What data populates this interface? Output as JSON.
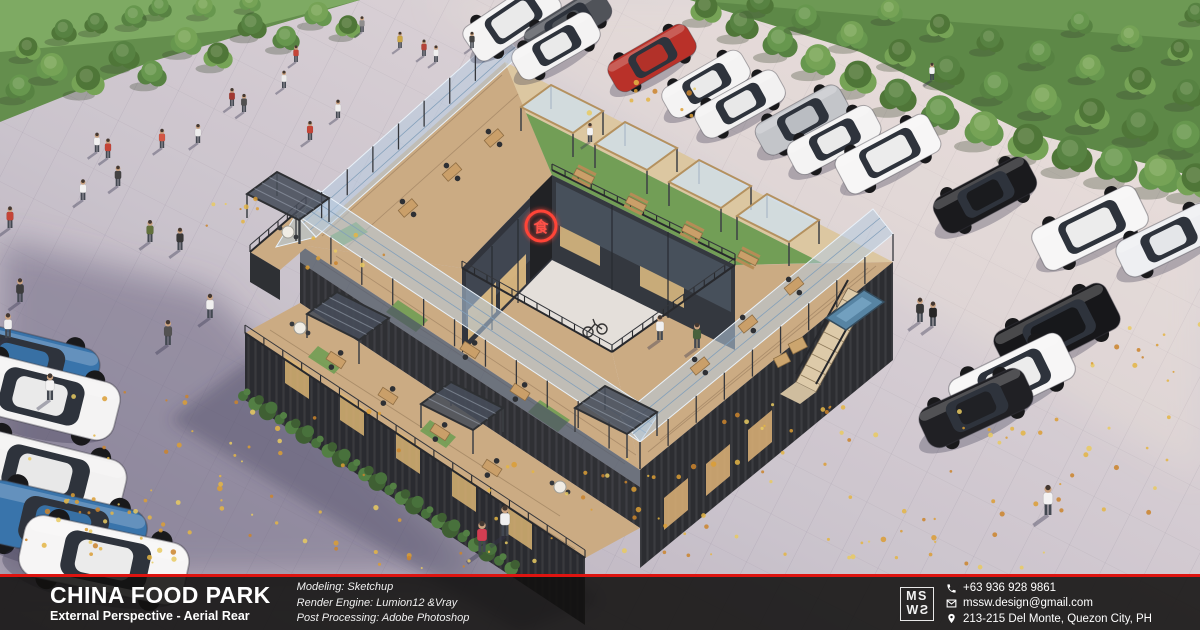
{
  "footer": {
    "project_title": "CHINA FOOD PARK",
    "subtitle": "External Perspective - Aerial Rear",
    "credits": [
      "Modeling: Sketchup",
      "Render Engine: Lumion12 &Vray",
      "Post Processing: Adobe Photoshop"
    ],
    "logo": {
      "top": "MS",
      "bottom": "SW"
    },
    "contacts": [
      {
        "icon": "phone-icon",
        "text": "+63 936 928 9861"
      },
      {
        "icon": "mail-icon",
        "text": "mssw.design@gmail.com"
      },
      {
        "icon": "pin-icon",
        "text": "213-215 Del Monte, Quezon City, PH"
      }
    ],
    "accent_color": "#de1410"
  },
  "sign": {
    "glyph": "食",
    "color": "#ff3b2f"
  },
  "scene": {
    "palette": {
      "tree_greens": [
        "#4e7d39",
        "#5f9346",
        "#6fa04e",
        "#46702f"
      ],
      "leaf_colors": [
        "#e3b33c",
        "#d99a2b",
        "#c97f22",
        "#e8c95a"
      ],
      "hedge_greens": [
        "#3f6b33",
        "#4a7a3b",
        "#35582a"
      ]
    },
    "trees": [
      [
        20,
        96,
        15
      ],
      [
        52,
        76,
        16
      ],
      [
        88,
        90,
        17
      ],
      [
        124,
        64,
        16
      ],
      [
        152,
        82,
        15
      ],
      [
        186,
        50,
        16
      ],
      [
        218,
        64,
        15
      ],
      [
        252,
        34,
        15
      ],
      [
        286,
        46,
        14
      ],
      [
        318,
        22,
        14
      ],
      [
        348,
        34,
        13
      ],
      [
        64,
        38,
        13
      ],
      [
        134,
        24,
        13
      ],
      [
        204,
        14,
        12
      ],
      [
        28,
        56,
        13
      ],
      [
        96,
        30,
        12
      ],
      [
        160,
        14,
        12
      ],
      [
        250,
        8,
        11
      ],
      [
        706,
        18,
        16
      ],
      [
        742,
        34,
        17
      ],
      [
        780,
        52,
        18
      ],
      [
        818,
        70,
        18
      ],
      [
        858,
        88,
        19
      ],
      [
        898,
        106,
        19
      ],
      [
        940,
        124,
        20
      ],
      [
        984,
        140,
        20
      ],
      [
        1028,
        154,
        21
      ],
      [
        1072,
        166,
        21
      ],
      [
        1116,
        176,
        22
      ],
      [
        1160,
        186,
        22
      ],
      [
        1196,
        192,
        20
      ],
      [
        760,
        10,
        14
      ],
      [
        806,
        26,
        15
      ],
      [
        852,
        44,
        16
      ],
      [
        900,
        62,
        16
      ],
      [
        948,
        80,
        17
      ],
      [
        996,
        96,
        17
      ],
      [
        1044,
        110,
        18
      ],
      [
        1092,
        124,
        18
      ],
      [
        1140,
        136,
        19
      ],
      [
        1186,
        148,
        19
      ],
      [
        890,
        18,
        13
      ],
      [
        940,
        34,
        14
      ],
      [
        990,
        48,
        14
      ],
      [
        1040,
        62,
        15
      ],
      [
        1090,
        76,
        15
      ],
      [
        1140,
        90,
        16
      ],
      [
        1188,
        102,
        16
      ],
      [
        1080,
        30,
        13
      ],
      [
        1130,
        44,
        13
      ],
      [
        1180,
        58,
        13
      ],
      [
        1196,
        20,
        12
      ]
    ],
    "cars": [
      [
        512,
        20,
        -34,
        1.0,
        "#f4f4f4",
        "suv"
      ],
      [
        568,
        24,
        -32,
        0.95,
        "#474b52",
        "coupe"
      ],
      [
        556,
        46,
        -30,
        0.95,
        "#f4f4f4",
        "coupe"
      ],
      [
        652,
        58,
        -30,
        0.95,
        "#b6281f",
        "coupe"
      ],
      [
        706,
        84,
        -30,
        0.95,
        "#f4f4f4",
        "coupe"
      ],
      [
        740,
        104,
        -29,
        0.97,
        "#f2f2f2",
        "coupe"
      ],
      [
        802,
        120,
        -29,
        1.0,
        "#c0c3c8",
        "coupe"
      ],
      [
        834,
        140,
        -28,
        1.0,
        "#f4f4f4",
        "coupe"
      ],
      [
        888,
        154,
        -28,
        1.05,
        "#f7f7f7",
        "suv"
      ],
      [
        985,
        195,
        -28,
        1.1,
        "#0e0f12",
        "coupe"
      ],
      [
        1090,
        228,
        -26,
        1.15,
        "#f7f7f7",
        "suv"
      ],
      [
        1168,
        240,
        -26,
        1.1,
        "#eef0f3",
        "coupe"
      ],
      [
        1057,
        330,
        -27,
        1.25,
        "#0b0c0f",
        "suv"
      ],
      [
        1012,
        379,
        -26,
        1.25,
        "#f7f7f7",
        "suv"
      ],
      [
        976,
        408,
        -25,
        1.2,
        "#15161a",
        "coupe"
      ],
      [
        22,
        362,
        14,
        1.6,
        "#2f6ea8",
        "coupe"
      ],
      [
        40,
        396,
        14,
        1.65,
        "#f4f4f4",
        "coupe"
      ],
      [
        44,
        474,
        14,
        1.7,
        "#f2f2f2",
        "coupe"
      ],
      [
        62,
        526,
        13,
        1.75,
        "#2f6ea8",
        "coupe"
      ],
      [
        104,
        560,
        12,
        1.75,
        "#f6f6f6",
        "coupe"
      ]
    ],
    "people": [
      [
        97,
        152,
        "#f2f2f2"
      ],
      [
        108,
        158,
        "#c23b2e"
      ],
      [
        83,
        200,
        "#f2f2f2"
      ],
      [
        118,
        186,
        "#3a3a3a"
      ],
      [
        162,
        148,
        "#d14f3c"
      ],
      [
        198,
        143,
        "#ececec"
      ],
      [
        232,
        106,
        "#9c2f26"
      ],
      [
        244,
        112,
        "#474747"
      ],
      [
        284,
        88,
        "#ececec"
      ],
      [
        296,
        62,
        "#c23b2e"
      ],
      [
        362,
        32,
        "#8a8a8a"
      ],
      [
        400,
        48,
        "#caa43c"
      ],
      [
        424,
        56,
        "#b03a30"
      ],
      [
        436,
        62,
        "#f0f0f0"
      ],
      [
        472,
        48,
        "#3b3b3b"
      ],
      [
        590,
        142,
        "#f4f4f4"
      ],
      [
        310,
        140,
        "#c23b2e"
      ],
      [
        338,
        118,
        "#f0f0f0"
      ],
      [
        10,
        228,
        "#c23b2e"
      ],
      [
        20,
        302,
        "#333333"
      ],
      [
        8,
        338,
        "#f0f0f0"
      ],
      [
        50,
        400,
        "#f4f4f4"
      ],
      [
        150,
        242,
        "#5a6b33"
      ],
      [
        180,
        250,
        "#2e2e2e"
      ],
      [
        210,
        318,
        "#f0f0f0"
      ],
      [
        168,
        345,
        "#4a4a4a"
      ],
      [
        482,
        552,
        "#d0354a"
      ],
      [
        505,
        536,
        "#f0f0f0"
      ],
      [
        920,
        322,
        "#2e2e2e"
      ],
      [
        933,
        326,
        "#1b1b1b"
      ],
      [
        1048,
        515,
        "#f4f4f4"
      ],
      [
        932,
        80,
        "#f4f4f4"
      ],
      [
        660,
        340,
        "#f0f0f0"
      ],
      [
        697,
        348,
        "#3f5a33"
      ]
    ],
    "pergolas": [
      [
        562,
        131,
        "glass"
      ],
      [
        636,
        168,
        "glass"
      ],
      [
        710,
        206,
        "glass"
      ],
      [
        778,
        240,
        "glass"
      ],
      [
        348,
        338,
        "dark"
      ],
      [
        462,
        428,
        "dark"
      ],
      [
        288,
        218,
        "dark"
      ],
      [
        616,
        432,
        "dark"
      ]
    ],
    "tables": [
      [
        408,
        208,
        -41,
        "wood"
      ],
      [
        452,
        172,
        -41,
        "wood"
      ],
      [
        494,
        138,
        -41,
        "wood"
      ],
      [
        584,
        176,
        27,
        "picnic"
      ],
      [
        636,
        204,
        27,
        "picnic"
      ],
      [
        692,
        232,
        27,
        "picnic"
      ],
      [
        748,
        258,
        27,
        "picnic"
      ],
      [
        700,
        366,
        -39,
        "wood"
      ],
      [
        748,
        324,
        -39,
        "wood"
      ],
      [
        794,
        286,
        -39,
        "wood"
      ],
      [
        470,
        350,
        33,
        "wood"
      ],
      [
        520,
        392,
        33,
        "wood"
      ],
      [
        336,
        360,
        33,
        "wood"
      ],
      [
        388,
        396,
        33,
        "wood"
      ],
      [
        440,
        432,
        33,
        "wood"
      ],
      [
        492,
        468,
        33,
        "wood"
      ],
      [
        300,
        328,
        0,
        "round"
      ],
      [
        560,
        487,
        0,
        "round"
      ],
      [
        288,
        232,
        0,
        "round"
      ]
    ],
    "railings": [
      [
        245,
        333,
        585,
        558,
        18,
        8
      ],
      [
        462,
        268,
        612,
        352,
        12,
        7
      ],
      [
        612,
        352,
        735,
        265,
        12,
        7
      ],
      [
        552,
        170,
        735,
        260,
        14,
        6
      ],
      [
        250,
        252,
        306,
        204,
        6,
        7
      ]
    ],
    "canopy_posts": [
      [
        296,
        215,
        501,
        32,
        8,
        26
      ],
      [
        300,
        217,
        640,
        442,
        11,
        27
      ],
      [
        640,
        442,
        893,
        234,
        9,
        27
      ]
    ],
    "hedges": [
      [
        243,
        396,
        560,
        600,
        26
      ]
    ],
    "leaf_clusters": [
      [
        215,
        470,
        190,
        85,
        55
      ],
      [
        100,
        535,
        90,
        38,
        25
      ],
      [
        625,
        512,
        150,
        55,
        35
      ],
      [
        772,
        432,
        70,
        35,
        15
      ],
      [
        1010,
        480,
        170,
        75,
        40
      ],
      [
        1150,
        352,
        60,
        30,
        12
      ],
      [
        642,
        96,
        55,
        22,
        10
      ],
      [
        345,
        252,
        40,
        18,
        8
      ],
      [
        905,
        555,
        120,
        25,
        18
      ],
      [
        455,
        565,
        80,
        18,
        12
      ],
      [
        240,
        210,
        40,
        16,
        8
      ]
    ]
  }
}
